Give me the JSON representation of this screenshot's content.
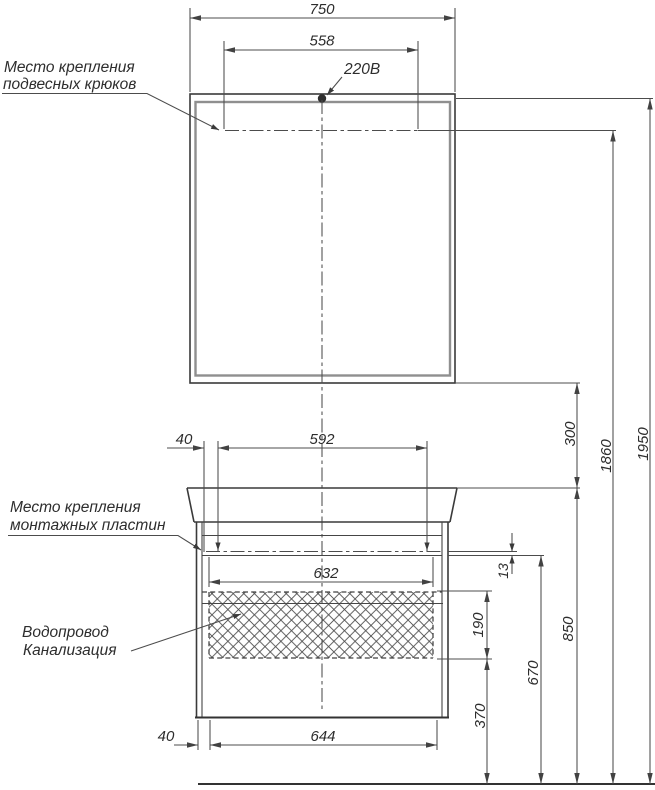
{
  "drawing": {
    "labels": {
      "hooks_line1": "Место крепления",
      "hooks_line2": "подвесных крюков",
      "plates_line1": "Место крепления",
      "plates_line2": "монтажных пластин",
      "water_line1": "Водопровод",
      "water_line2": "Канализация",
      "power": "220В"
    },
    "dims": {
      "total_width": "750",
      "hooks_span": "558",
      "plates_inset": "40",
      "plates_span": "592",
      "top_inner_width": "632",
      "bottom_inner_width": "644",
      "bottom_inset": "40",
      "plate_offset": "13",
      "mirror_gap": "300",
      "hooks_height": "1860",
      "total_height": "1950",
      "plates_height": "670",
      "basin_height": "850",
      "utility_zone_height": "190",
      "lower_zone_height": "370"
    },
    "colors": {
      "background": "#ffffff",
      "object_line": "#3a3a3a",
      "dimension_line": "#4c4c4c",
      "mirror_frame": "#8f8f8f",
      "text": "#2d2d2d"
    }
  }
}
